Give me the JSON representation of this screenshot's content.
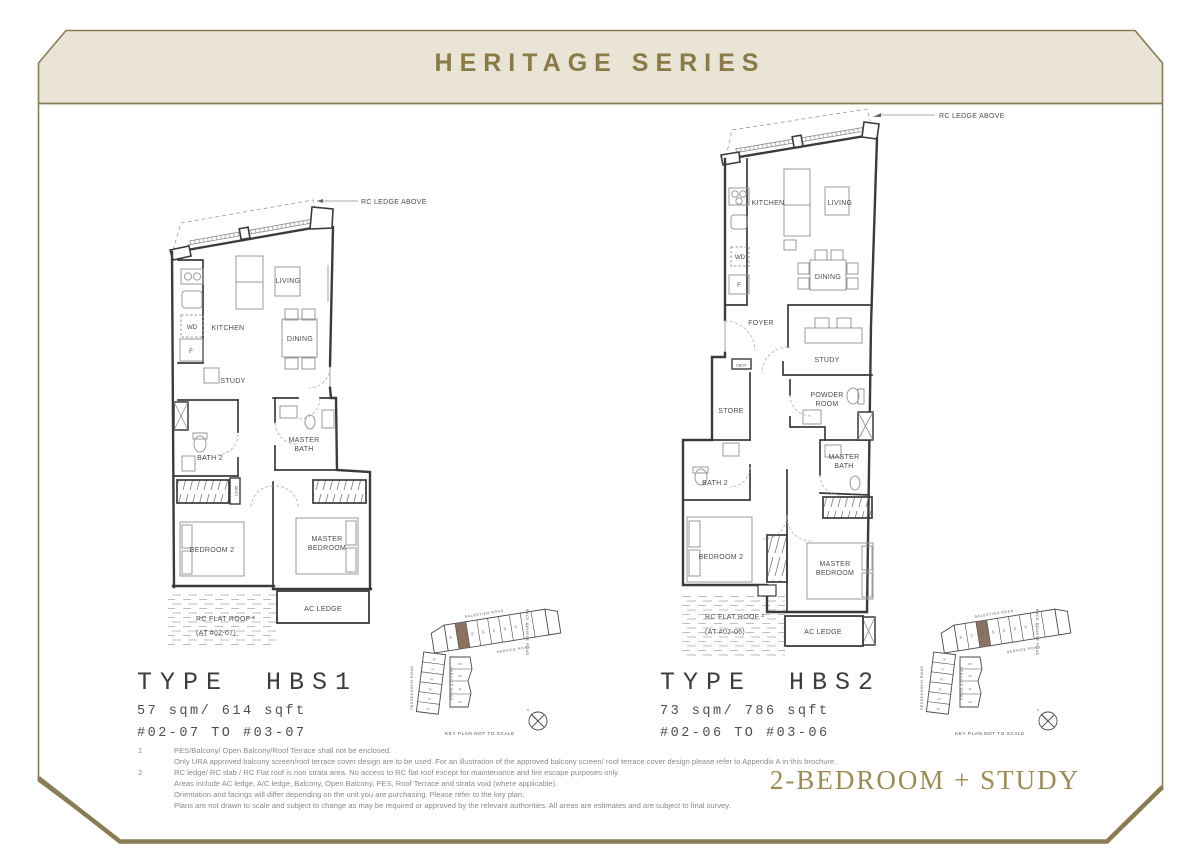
{
  "header": {
    "title": "HERITAGE SERIES",
    "title_color": "#8a7a45",
    "band_color": "#e9e4d6",
    "frame_color": "#8a7c52"
  },
  "category_label": "2-BEDROOM + STUDY",
  "plans": [
    {
      "type_label": "TYPE HBS1",
      "area": "57 sqm/ 614 sqft",
      "units": "#02-07 TO #03-07",
      "rc_ledge_above": "RC LEDGE ABOVE",
      "rooms": {
        "kitchen": "KITCHEN",
        "living": "LIVING",
        "dining": "DINING",
        "study": "STUDY",
        "wd": "WD",
        "f": "F",
        "dbst": "DB/ST",
        "bath2": "BATH 2",
        "master_bath_1": "MASTER",
        "master_bath_2": "BATH",
        "bedroom2": "BEDROOM 2",
        "master_bedroom_1": "MASTER",
        "master_bedroom_2": "BEDROOM",
        "ac_ledge": "AC LEDGE",
        "rc_flat_roof_1": "RC FLAT ROOF ²",
        "rc_flat_roof_2": "(AT #02-07)"
      }
    },
    {
      "type_label": "TYPE HBS2",
      "area": "73 sqm/ 786 sqft",
      "units": "#02-06 TO #03-06",
      "rc_ledge_above": "RC LEDGE ABOVE",
      "rooms": {
        "kitchen": "KITCHEN",
        "living": "LIVING",
        "dining": "DINING",
        "study": "STUDY",
        "foyer": "FOYER",
        "store": "STORE",
        "powder_1": "POWDER",
        "powder_2": "ROOM",
        "wd": "WD",
        "f": "F",
        "dbst": "DB/ST",
        "bath2": "BATH 2",
        "master_bath_1": "MASTER",
        "master_bath_2": "BATH",
        "bedroom2": "BEDROOM 2",
        "master_bedroom_1": "MASTER",
        "master_bedroom_2": "BEDROOM",
        "ac_ledge": "AC LEDGE",
        "rc_flat_roof_1": "RC FLAT ROOF ²",
        "rc_flat_roof_2": "(AT #02-06)"
      }
    }
  ],
  "keyplan": {
    "caption": "KEY PLAN NOT TO SCALE",
    "north": "N",
    "highlight_color": "#8b7262",
    "roads": {
      "balestier": "BALESTIER  ROAD",
      "race_course": "RACE COURSE ROAD",
      "tessensohn": "TESSENSOHN  ROAD",
      "service": "SERVICE ROAD"
    },
    "top_units": [
      "08",
      "07",
      "06",
      "05",
      "04",
      "03",
      "02",
      "01"
    ],
    "left_units": [
      "18",
      "17",
      "16",
      "15",
      "14",
      "13"
    ],
    "mid_units": [
      "09",
      "10",
      "11",
      "12"
    ]
  },
  "footnotes": {
    "items": [
      {
        "num": "1",
        "text": "PES/Balcony/ Open Balcony/Roof Terrace shall not be enclosed."
      },
      {
        "num": "",
        "text": "Only URA approved balcony screen/roof terrace cover design are to be used. For an illustration of the approved balcony screen/ roof terrace cover design please refer to Appendix A in this brochure."
      },
      {
        "num": "2",
        "text": "RC ledge/ RC slab / RC Flat roof is non strata area. No access to RC flat roof except for maintenance and fire escape purposes only."
      },
      {
        "num": "",
        "text": "Areas include AC ledge, A/C ledge, Balcony, Open Balcony, PES, Roof Terrace and strata void  (where applicable)."
      },
      {
        "num": "",
        "text": "Orientation and facings will differ depending on the unit you are purchasing. Please refer to the key plan."
      },
      {
        "num": "",
        "text": "Plans are not drawn to scale and subject to change as may be required or approved by the relevant authorities. All areas are estimates and are subject to final survey."
      }
    ]
  }
}
